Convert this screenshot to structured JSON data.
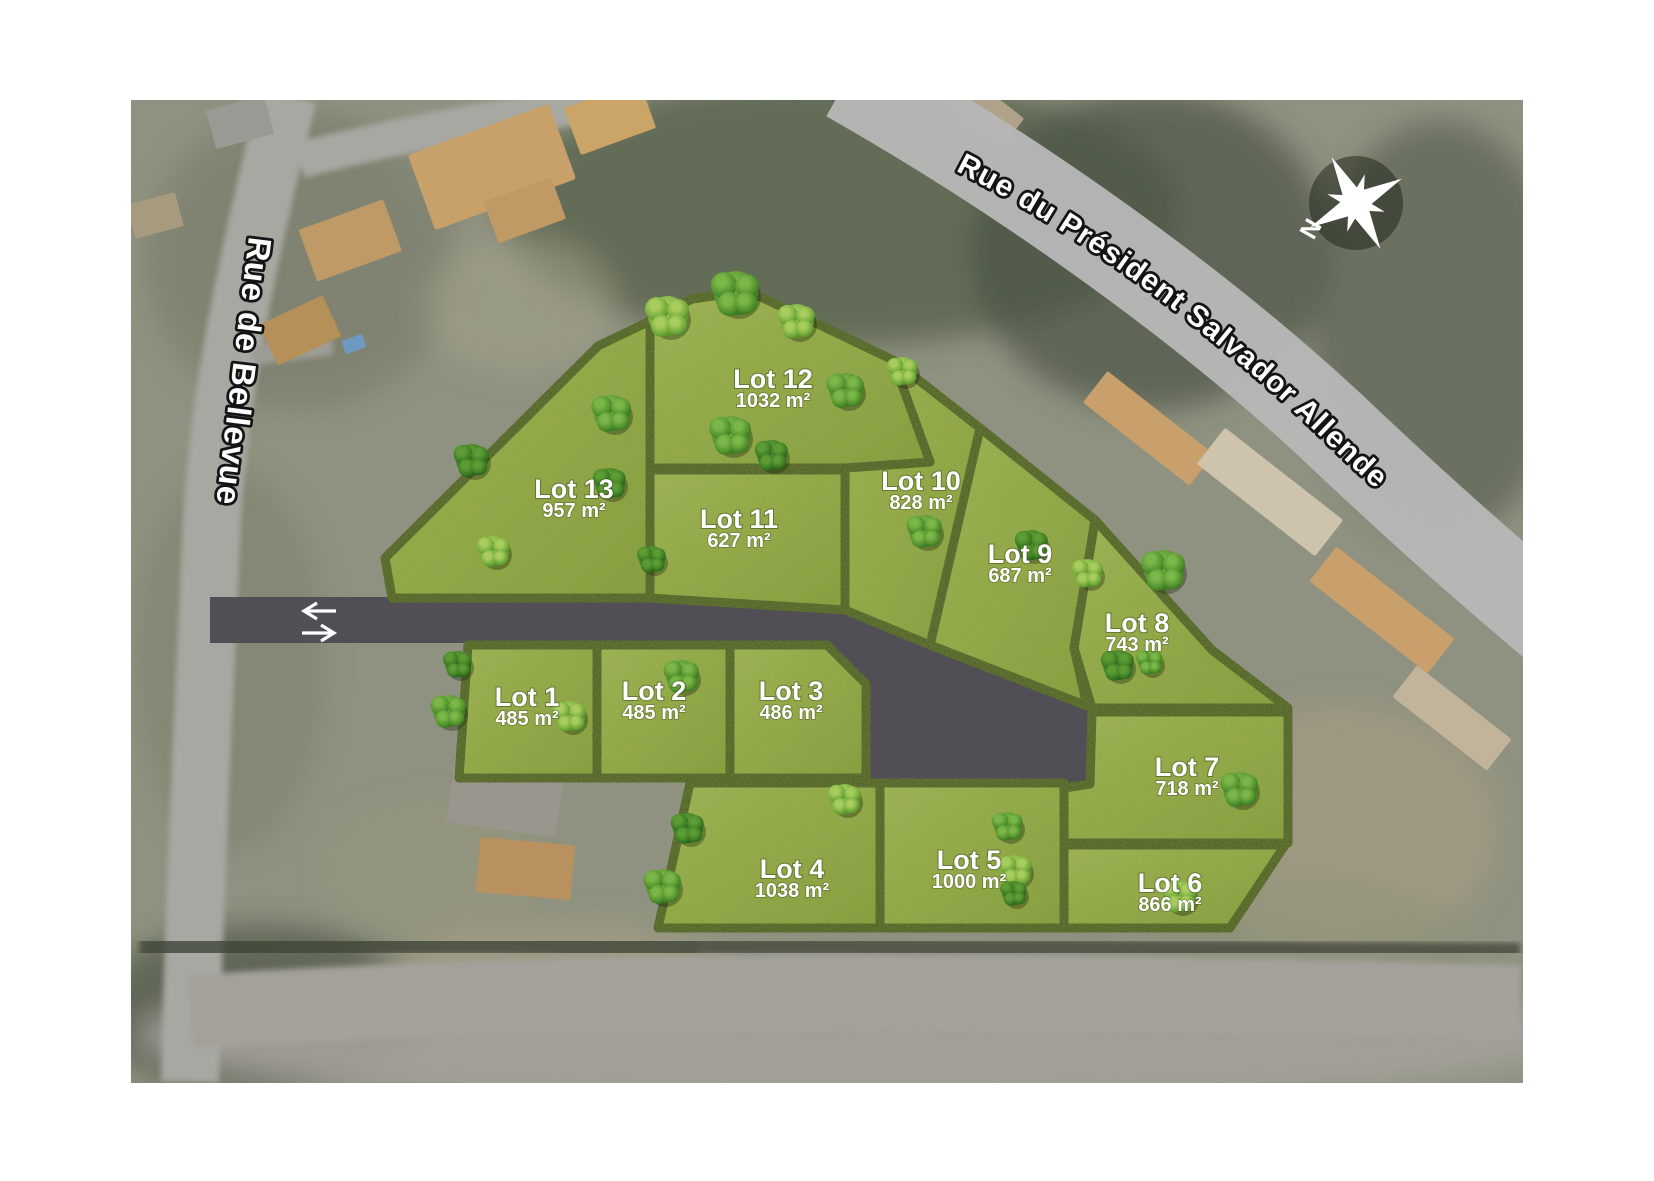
{
  "map": {
    "streets": {
      "left": "Rue de Bellevue",
      "top": "Rue du Président Salvador Allende"
    },
    "compass_label": "N",
    "colors": {
      "grass": "#98ae4a",
      "hedge": "#4d5c28",
      "access_road": "#514e56",
      "street_road": "#b7b7b7",
      "label_text": "#ffffff"
    },
    "lots": [
      {
        "id": 1,
        "name": "Lot 1",
        "area": "485 m²",
        "label": [
          527,
          706
        ],
        "points": "468,645 597,645 597,778 459,778"
      },
      {
        "id": 2,
        "name": "Lot 2",
        "area": "485 m²",
        "label": [
          654,
          700
        ],
        "points": "597,645 730,645 730,778 597,778"
      },
      {
        "id": 3,
        "name": "Lot 3",
        "area": "486 m²",
        "label": [
          791,
          700
        ],
        "points": "730,645 827,645 866,684 866,778 730,778"
      },
      {
        "id": 4,
        "name": "Lot 4",
        "area": "1038 m²",
        "label": [
          792,
          878
        ],
        "points": "690,783 880,783 880,928 658,928"
      },
      {
        "id": 5,
        "name": "Lot 5",
        "area": "1000 m²",
        "label": [
          969,
          869
        ],
        "points": "880,783 1064,783 1064,928 880,928"
      },
      {
        "id": 6,
        "name": "Lot 6",
        "area": "866 m²",
        "label": [
          1170,
          892
        ],
        "points": "1064,845 1285,845 1230,928 1064,928"
      },
      {
        "id": 7,
        "name": "Lot 7",
        "area": "718 m²",
        "label": [
          1187,
          776
        ],
        "points": "1092,712 1288,712 1288,843 1064,843 1064,788 1090,784"
      },
      {
        "id": 8,
        "name": "Lot 8",
        "area": "743 m²",
        "label": [
          1137,
          632
        ],
        "points": "1095,520 1212,650 1288,708 1092,708 1074,648"
      },
      {
        "id": 9,
        "name": "Lot 9",
        "area": "687 m²",
        "label": [
          1020,
          563
        ],
        "points": "980,428 1030,468 1095,520 1074,648 1087,706 930,645"
      },
      {
        "id": 10,
        "name": "Lot 10",
        "area": "828 m²",
        "label": [
          921,
          490
        ],
        "points": "893,360 980,428 930,645 845,610 845,468 930,462"
      },
      {
        "id": 11,
        "name": "Lot 11",
        "area": "627 m²",
        "label": [
          739,
          528
        ],
        "points": "650,470 845,470 845,610 650,598"
      },
      {
        "id": 12,
        "name": "Lot 12",
        "area": "1032 m²",
        "label": [
          773,
          388
        ],
        "points": "650,321 692,299 748,291 822,326 893,360 930,462 845,468 650,468"
      },
      {
        "id": 13,
        "name": "Lot 13",
        "area": "957 m²",
        "label": [
          574,
          498
        ],
        "points": "385,558 598,346 650,321 650,598 392,598"
      }
    ],
    "trees": [
      [
        668,
        316,
        20,
        1
      ],
      [
        736,
        293,
        22,
        0
      ],
      [
        797,
        321,
        17,
        1
      ],
      [
        612,
        413,
        18,
        0
      ],
      [
        610,
        483,
        15,
        2
      ],
      [
        494,
        551,
        15,
        1
      ],
      [
        472,
        460,
        16,
        2
      ],
      [
        731,
        435,
        19,
        0
      ],
      [
        772,
        455,
        15,
        2
      ],
      [
        846,
        390,
        17,
        0
      ],
      [
        903,
        371,
        14,
        1
      ],
      [
        925,
        531,
        16,
        0
      ],
      [
        1032,
        545,
        15,
        2
      ],
      [
        1088,
        573,
        14,
        1
      ],
      [
        1164,
        570,
        20,
        0
      ],
      [
        652,
        559,
        13,
        2
      ],
      [
        449,
        711,
        16,
        0
      ],
      [
        458,
        664,
        13,
        2
      ],
      [
        570,
        716,
        15,
        1
      ],
      [
        682,
        676,
        16,
        0
      ],
      [
        688,
        828,
        15,
        2
      ],
      [
        663,
        886,
        17,
        0
      ],
      [
        845,
        799,
        15,
        1
      ],
      [
        1008,
        826,
        14,
        0
      ],
      [
        1016,
        870,
        15,
        1
      ],
      [
        1014,
        893,
        12,
        2
      ],
      [
        1240,
        789,
        17,
        0
      ],
      [
        1180,
        896,
        16,
        1
      ],
      [
        1118,
        665,
        15,
        2
      ],
      [
        1150,
        662,
        12,
        0
      ]
    ]
  }
}
